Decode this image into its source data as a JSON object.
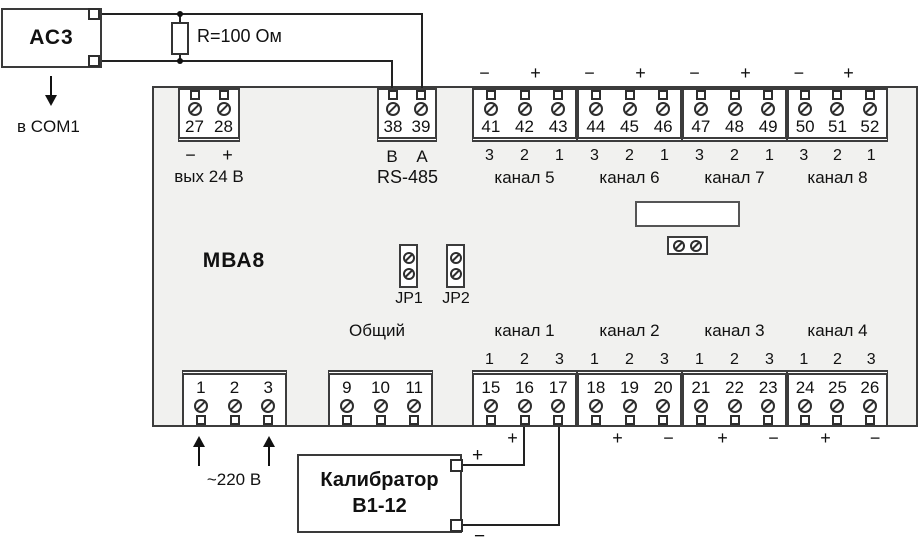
{
  "device": {
    "name": "МВА8",
    "jumper1": "JP1",
    "jumper2": "JP2",
    "common_label": "Общий"
  },
  "ac3": {
    "label": "АС3",
    "dest_label": "в COM1"
  },
  "resistor": {
    "label": "R=100 Ом"
  },
  "power": {
    "label": "~220 В"
  },
  "calibrator": {
    "line1": "Калибратор",
    "line2": "В1-12",
    "plus": "+",
    "minus": "−"
  },
  "blocks": {
    "out24": {
      "terminals": [
        "27",
        "28"
      ],
      "minus": "−",
      "plus": "+",
      "caption": "вых 24 В"
    },
    "rs485": {
      "terminals": [
        "38",
        "39"
      ],
      "lines": [
        "B",
        "A"
      ],
      "caption": "RS-485"
    },
    "ch5": {
      "minus": "−",
      "plus": "+",
      "terminals": [
        "41",
        "42",
        "43"
      ],
      "positions": [
        "3",
        "2",
        "1"
      ],
      "caption": "канал 5"
    },
    "ch6": {
      "minus": "−",
      "plus": "+",
      "terminals": [
        "44",
        "45",
        "46"
      ],
      "positions": [
        "3",
        "2",
        "1"
      ],
      "caption": "канал 6"
    },
    "ch7": {
      "minus": "−",
      "plus": "+",
      "terminals": [
        "47",
        "48",
        "49"
      ],
      "positions": [
        "3",
        "2",
        "1"
      ],
      "caption": "канал 7"
    },
    "ch8": {
      "minus": "−",
      "plus": "+",
      "terminals": [
        "50",
        "51",
        "52"
      ],
      "positions": [
        "3",
        "2",
        "1"
      ],
      "caption": "канал 8"
    },
    "power_in": {
      "terminals": [
        "1",
        "2",
        "3"
      ]
    },
    "common": {
      "terminals": [
        "9",
        "10",
        "11"
      ]
    },
    "ch1": {
      "caption": "канал 1",
      "positions": [
        "1",
        "2",
        "3"
      ],
      "terminals": [
        "15",
        "16",
        "17"
      ],
      "plus": "+"
    },
    "ch2": {
      "caption": "канал 2",
      "positions": [
        "1",
        "2",
        "3"
      ],
      "terminals": [
        "18",
        "19",
        "20"
      ],
      "plus": "+",
      "minus": "−"
    },
    "ch3": {
      "caption": "канал 3",
      "positions": [
        "1",
        "2",
        "3"
      ],
      "terminals": [
        "21",
        "22",
        "23"
      ],
      "plus": "+",
      "minus": "−"
    },
    "ch4": {
      "caption": "канал 4",
      "positions": [
        "1",
        "2",
        "3"
      ],
      "terminals": [
        "24",
        "25",
        "26"
      ],
      "plus": "+",
      "minus": "−"
    }
  }
}
